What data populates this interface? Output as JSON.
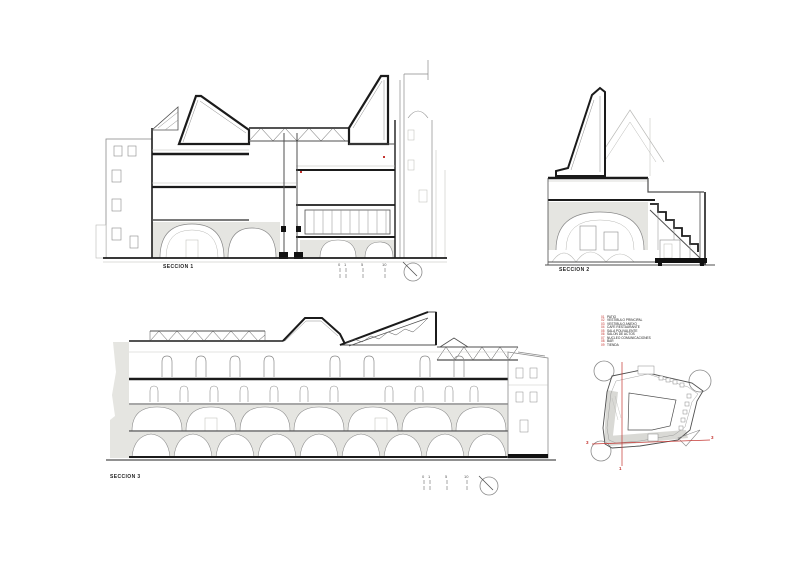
{
  "sheet": {
    "type": "architectural-sections-sheet"
  },
  "sections": [
    {
      "id": "seccion-1",
      "label": "SECCION 1"
    },
    {
      "id": "seccion-2",
      "label": "SECCION 2"
    },
    {
      "id": "seccion-3",
      "label": "SECCION 3"
    }
  ],
  "scalebar": {
    "numbers": [
      "0",
      "1",
      "5",
      "10"
    ]
  },
  "legend": {
    "items": [
      {
        "num": "01",
        "label": "PATIO"
      },
      {
        "num": "02",
        "label": "VESTIBULO PRINCIPAL"
      },
      {
        "num": "03",
        "label": "VESTIBULO ANEXO"
      },
      {
        "num": "04",
        "label": "CAFE RESTAURANTE"
      },
      {
        "num": "05",
        "label": "SALA POLIVALENTE"
      },
      {
        "num": "06",
        "label": "SALON DE ACTOS"
      },
      {
        "num": "07",
        "label": "NUCLEO COMUNICACIONES"
      },
      {
        "num": "08",
        "label": "BAR"
      },
      {
        "num": "09",
        "label": "TIENDA"
      }
    ]
  },
  "keyplan": {
    "marks": {
      "left": "3",
      "right": "3",
      "bottom": "1"
    }
  },
  "colors": {
    "accent_red": "#c43430",
    "cut_line": "#1b1b1b",
    "poche_gray": "#e5e5e1",
    "background": "#ffffff"
  }
}
